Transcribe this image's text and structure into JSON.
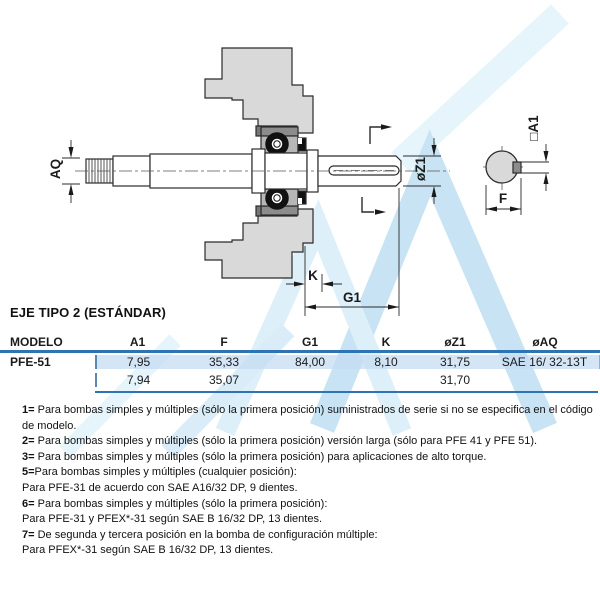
{
  "section_title": "EJE TIPO 2 (ESTÁNDAR)",
  "drawing": {
    "labels": {
      "aq": "AQ",
      "z1": "øZ1",
      "a1": "□A1",
      "f": "F",
      "k": "K",
      "g1": "G1"
    },
    "colors": {
      "housing_fill": "#d9d9d9",
      "bearing_block": "#b7b7b7",
      "bearing_cap": "#8c8c8c",
      "key_fill": "#8c8c8c",
      "line": "#2b2b2b",
      "watermark_light": "#d7edf9",
      "watermark_mid": "#c8e5f4",
      "watermark_dark": "#a5d2ec"
    }
  },
  "table": {
    "accent_color": "#2e74b5",
    "highlight_color": "#c4dcf2",
    "columns": [
      "MODELO",
      "A1",
      "F",
      "G1",
      "K",
      "øZ1",
      "øAQ"
    ],
    "rows": [
      {
        "modelo": "PFE-51",
        "values": [
          "7,95",
          "35,33",
          "84,00",
          "8,10",
          "31,75",
          "SAE 16/ 32-13T"
        ],
        "highlight": true
      },
      {
        "modelo": "",
        "values": [
          "7,94",
          "35,07",
          "",
          "",
          "31,70",
          ""
        ],
        "highlight": false
      }
    ]
  },
  "footnotes": [
    {
      "num": "1=",
      "text": " Para bombas simples y múltiples (sólo la primera posición) suministrados de serie si no se especifica en el código de modelo."
    },
    {
      "num": "2=",
      "text": " Para bombas simples y múltiples (sólo la primera posición) versión larga (sólo para PFE 41 y PFE 51)."
    },
    {
      "num": "3=",
      "text": " Para bombas simples y múltiples (sólo la primera posición) para aplicaciones de alto torque."
    },
    {
      "num": "5=",
      "text": "Para bombas simples y múltiples (cualquier posición):"
    },
    {
      "num": "",
      "text": "Para PFE-31 de acuerdo con SAE A16/32 DP, 9 dientes."
    },
    {
      "num": "6=",
      "text": " Para bombas simples y múltiples (sólo la primera posición):"
    },
    {
      "num": "",
      "text": "Para PFE-31 y PFEX*-31 según SAE B 16/32 DP, 13 dientes."
    },
    {
      "num": "7=",
      "text": " De segunda y tercera posición en la bomba de configuración múltiple:"
    },
    {
      "num": "",
      "text": "Para PFEX*-31 según SAE B 16/32 DP, 13 dientes."
    }
  ]
}
